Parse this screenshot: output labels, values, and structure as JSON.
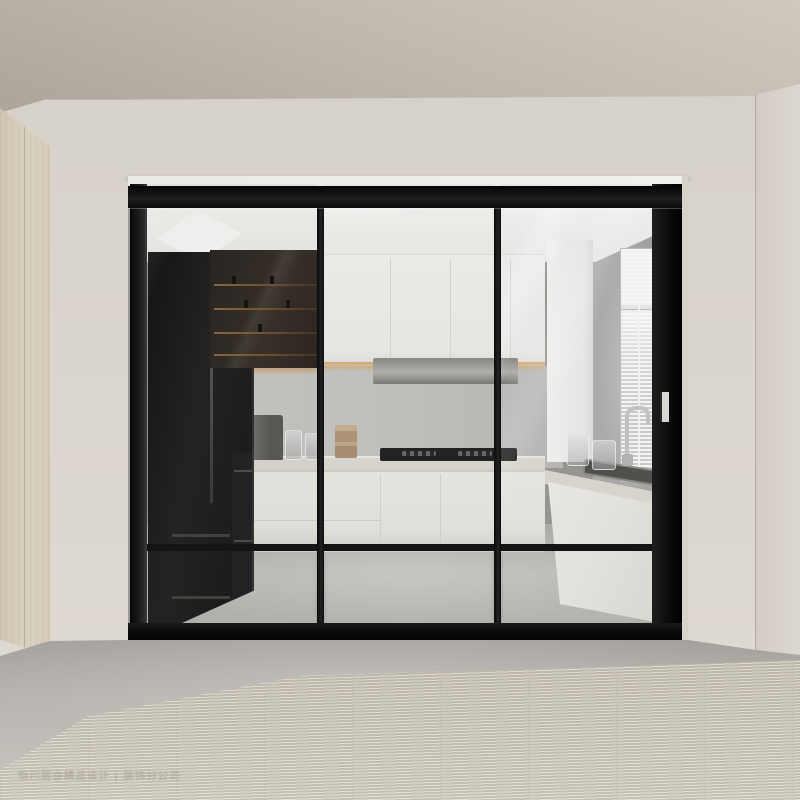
{
  "meta": {
    "image_type": "interior-photograph",
    "subject": "Modern white kitchen enclosed by black slim-frame three-panel sliding glass doors, viewed from a hallway with a beige woven rug"
  },
  "watermark": {
    "text": "怡川居@精品设计 | 装饰分公司"
  },
  "palette": {
    "wall": "#d9d4cc",
    "ceiling": "#b7b0a6",
    "wardrobe_wood": "#d6cebd",
    "door_frame": "#141414",
    "cabinet_white": "#f1efec",
    "black_unit": "#1c1c1d",
    "backsplash": "#c5c4c1",
    "countertop": "#dcdad2",
    "exterior_floor": "#b3b0ab",
    "rug": "#cac5b9",
    "window_wall": "#a9a8a6",
    "warm_light": "#c89a5e"
  },
  "scene": {
    "elements": [
      "ceiling",
      "left-wardrobe",
      "greige-walls",
      "doorway-opening",
      "sliding-glass-door-panel-1",
      "sliding-glass-door-panel-2",
      "sliding-glass-door-panel-3",
      "door-top-track",
      "door-bottom-track",
      "door-handle",
      "black-refrigerator",
      "smoked-glass-display-cabinet",
      "wall-oven",
      "white-upper-cabinets",
      "range-hood",
      "under-cabinet-light",
      "gas-cooktop",
      "terrazzo-countertop",
      "white-base-cabinets",
      "kitchen-sink",
      "gooseneck-faucet",
      "glass-jars",
      "spice-canisters",
      "coffee-maker",
      "window-with-venetian-blinds",
      "concrete-floor",
      "woven-area-rug",
      "watermark"
    ]
  }
}
